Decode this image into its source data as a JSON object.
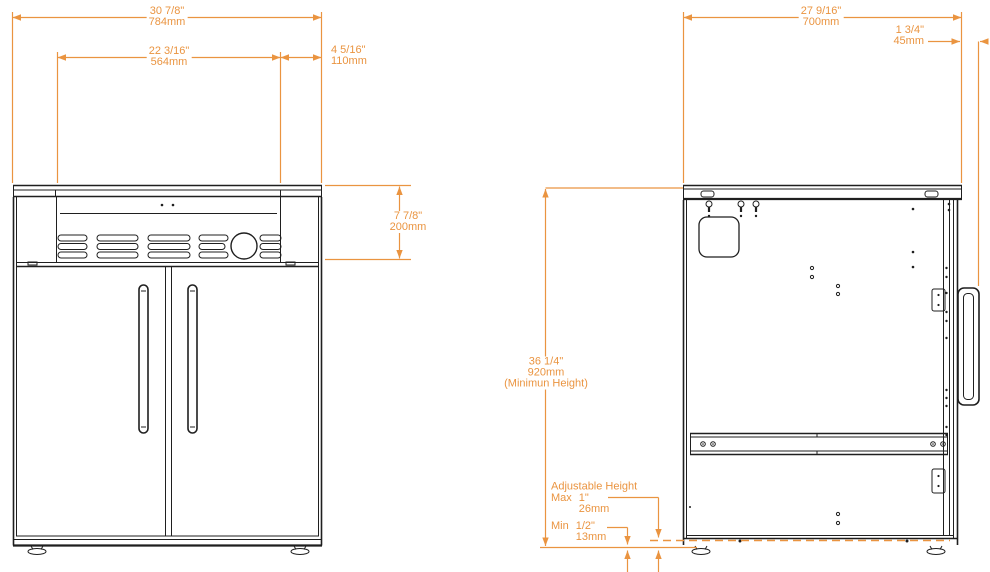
{
  "colors": {
    "dimension": "#ea9440",
    "ink": "#1f1f1f",
    "background": "#ffffff"
  },
  "views": {
    "front": {
      "dims": {
        "overall_width": {
          "inches": "30 7/8\"",
          "mm": "784mm"
        },
        "inner_width": {
          "inches": "22 3/16\"",
          "mm": "564mm"
        },
        "side_width": {
          "inches": "4 5/16\"",
          "mm": "110mm"
        },
        "top_height": {
          "inches": "7 7/8\"",
          "mm": "200mm"
        }
      }
    },
    "back": {
      "dims": {
        "overall_width": {
          "inches": "27 9/16\"",
          "mm": "700mm"
        },
        "handle_depth": {
          "inches": "1 3/4\"",
          "mm": "45mm"
        },
        "min_height": {
          "inches": "36 1/4\"",
          "mm": "920mm",
          "note": "(Minimun Height)"
        },
        "adjustable_height": {
          "title": "Adjustable Height",
          "max_label": "Max",
          "max_inches": "1\"",
          "max_mm": "26mm",
          "min_label": "Min",
          "min_inches": "1/2\"",
          "min_mm": "13mm"
        }
      }
    }
  }
}
